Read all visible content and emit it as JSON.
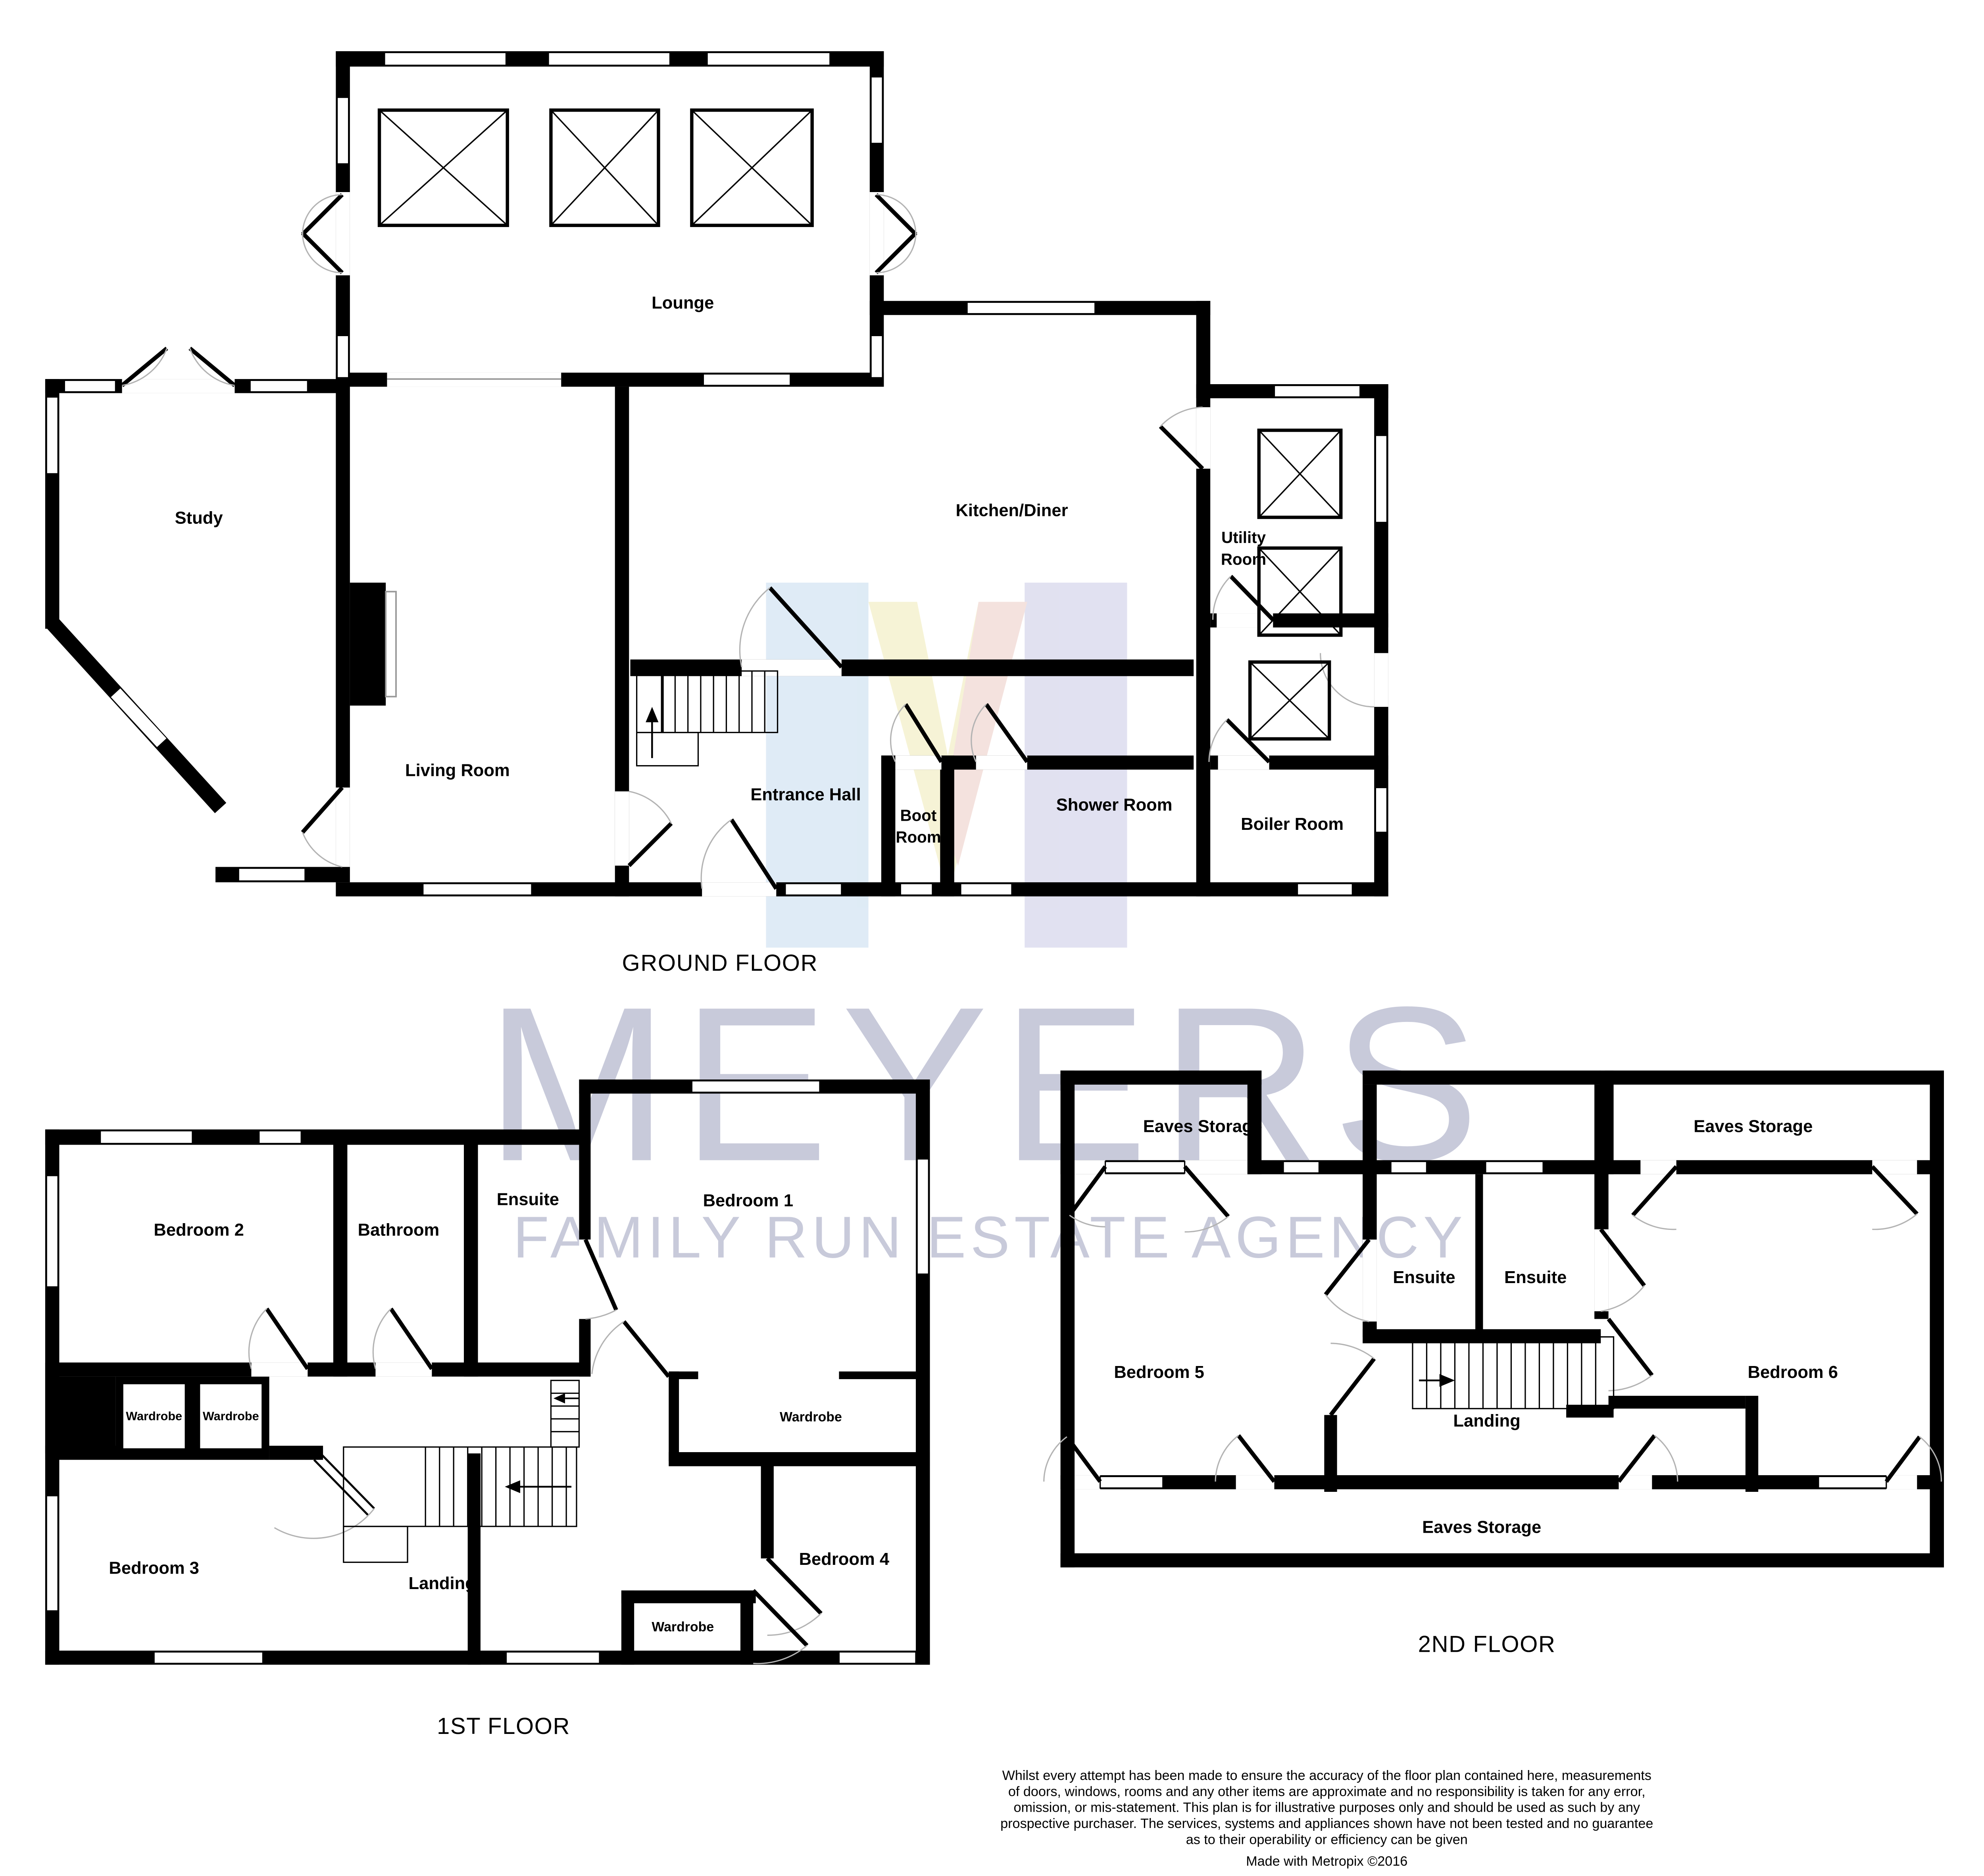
{
  "watermark": {
    "brand": "MEYERS",
    "tagline": "FAMILY RUN ESTATE AGENCY",
    "color": "#c8cada"
  },
  "logo_colors": {
    "blue": "#d9e8f4",
    "yellow": "#f5f1d0",
    "lavender": "#dcdcee",
    "pink": "#f3ddd9"
  },
  "ground": {
    "title": "GROUND FLOOR",
    "lounge": "Lounge",
    "study": "Study",
    "living": "Living Room",
    "kitchen": "Kitchen/Diner",
    "utility_line1": "Utility",
    "utility_line2": "Room",
    "hall": "Entrance Hall",
    "boot_line1": "Boot",
    "boot_line2": "Room",
    "shower": "Shower Room",
    "boiler": "Boiler Room"
  },
  "first": {
    "title": "1ST FLOOR",
    "bedroom1": "Bedroom 1",
    "bedroom2": "Bedroom 2",
    "bedroom3": "Bedroom 3",
    "bedroom4": "Bedroom 4",
    "bathroom": "Bathroom",
    "ensuite": "Ensuite",
    "landing": "Landing",
    "wardrobe": "Wardrobe"
  },
  "second": {
    "title": "2ND FLOOR",
    "bedroom5": "Bedroom 5",
    "bedroom6": "Bedroom 6",
    "ensuite": "Ensuite",
    "landing": "Landing",
    "eaves": "Eaves Storage"
  },
  "disclaimer": {
    "lines": [
      "Whilst every attempt has been made to ensure the accuracy of the floor plan contained here, measurements",
      "of doors, windows, rooms and any other items are approximate and no responsibility is taken for any error,",
      "omission, or mis-statement. This plan is for illustrative purposes only and should be used as such by any",
      "prospective purchaser. The services, systems and appliances shown have not been tested and no guarantee",
      "as to their operability or efficiency can be given"
    ],
    "credit": "Made with Metropix ©2016"
  },
  "symbols": {
    "skylight": "x-box",
    "door_swing": "quarter-arc",
    "stair_arrow": "direction-arrow"
  }
}
